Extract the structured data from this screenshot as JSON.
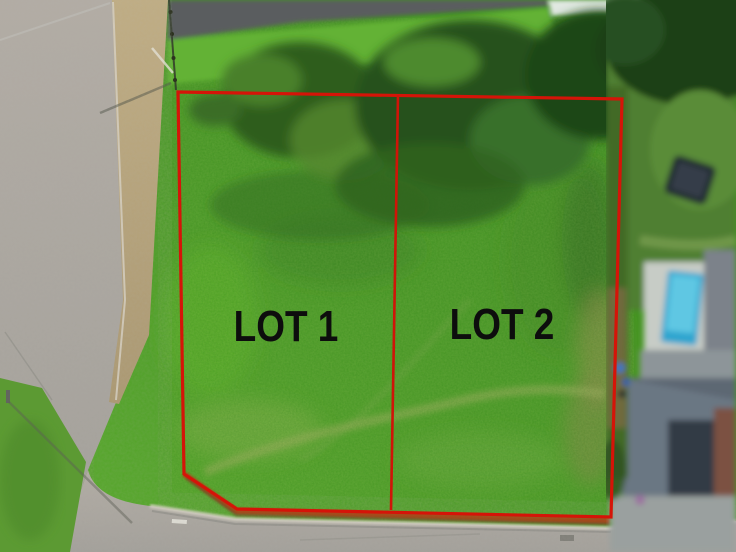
{
  "photo": {
    "description": "Aerial drone view of a grassy corner plot outlined in red and divided into two building lots, with a street on the left and bottom, trees along the top and a neighbouring house with swimming pool on the right",
    "width_px": 736,
    "height_px": 552
  },
  "overlay": {
    "boundary_color": "#d51408",
    "divider_color": "#d01408",
    "lots": [
      {
        "id": "lot-1",
        "label": "LOT 1"
      },
      {
        "id": "lot-2",
        "label": "LOT 2"
      }
    ]
  },
  "scene_palette": {
    "plot_grass": "#4f9e2a",
    "bright_grass": "#5cb02a",
    "tree_canopy": "#2a5a1a",
    "street_asphalt": "#aca69e",
    "sidewalk_tan": "#b9a67e",
    "curb_paint_red": "#b23c1a",
    "pool_blue": "#2da5cf",
    "house_gray": "#6b7783",
    "brick_brown": "#7b5142",
    "label_text": "#0d0d0d"
  }
}
